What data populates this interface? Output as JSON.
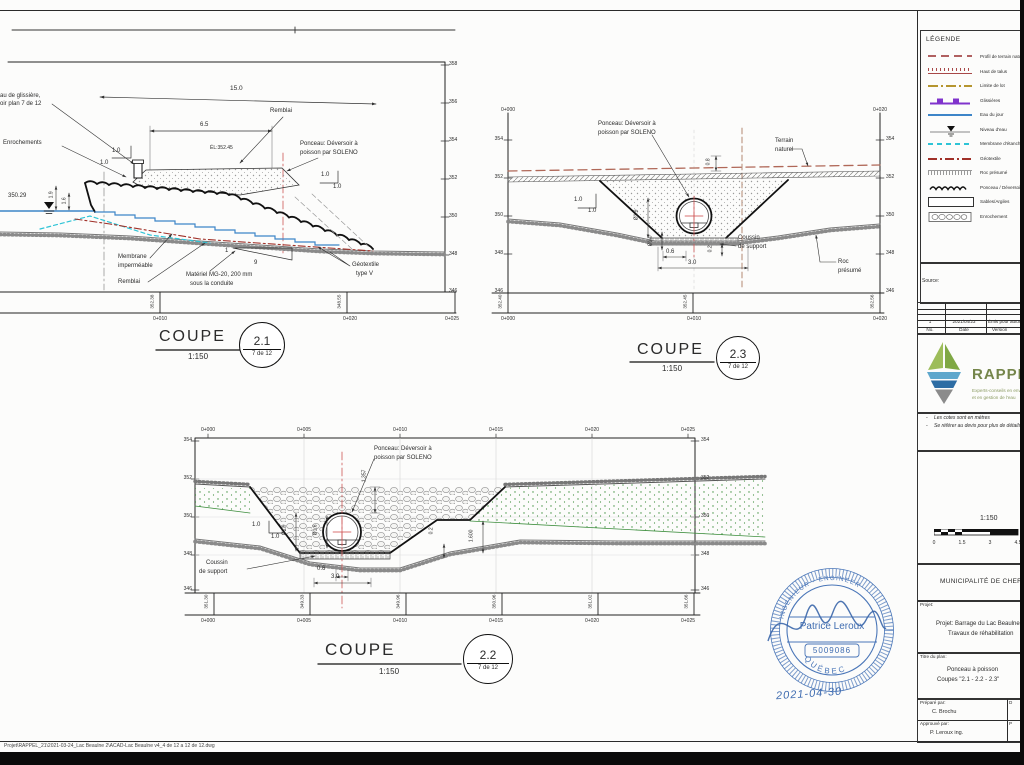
{
  "common": {
    "coupe": "COUPE",
    "scale": "1:150",
    "sheet_ref": "7 de 12",
    "ponceau_line1": "Ponceau: Déversoir à",
    "ponceau_line2": "poisson par SOLENO",
    "slope": "1.0"
  },
  "c21": {
    "bubble": "2.1",
    "elev": [
      "358",
      "356",
      "354",
      "352",
      "350",
      "348",
      "346"
    ],
    "stations": [
      "0+010",
      "0+020",
      "0+025"
    ],
    "datums": [
      "352.38",
      "348.55"
    ],
    "labels": {
      "glissiere1": "au de glissière,",
      "glissiere2": "oir plan 7 de 12",
      "enrochements": "Enrochements",
      "water_level": "350.29",
      "dim_h1": "1.9",
      "dim_h2": "1.6",
      "dim_crest": "6.5",
      "el_crest": "ÉL:352.45",
      "dim_base": "15.0",
      "remblai": "Remblai",
      "membrane1": "Membrane",
      "membrane2": "imperméable",
      "remblai2": "Remblai",
      "mg20_1": "Matériel MG-20, 200 mm",
      "mg20_2": "sous la conduite",
      "slope_v": "1",
      "slope_h": "9",
      "geotextile1": "Géotextile",
      "geotextile2": "type V"
    }
  },
  "c23": {
    "bubble": "2.3",
    "elev_left": [
      "354",
      "352",
      "350",
      "348",
      "346"
    ],
    "elev_right": [
      "354",
      "352",
      "350",
      "348",
      "346"
    ],
    "stations_top": [
      "0+000",
      "0+020"
    ],
    "stations": [
      "0+000",
      "0+010",
      "0+020"
    ],
    "datums": [
      "352.40",
      "352.45",
      "352.56"
    ],
    "labels": {
      "terrain1": "Terrain",
      "terrain2": "naturel",
      "dim_cover": "0.8",
      "dia_pipe": "Ø1.9",
      "dia_bed": "Ø1.0",
      "coussin1": "Coussin",
      "coussin2": "de support",
      "roc1": "Roc",
      "roc2": "présumé",
      "dim_key": "0.6",
      "dim_bed": "0.2",
      "dim_width": "3.0"
    }
  },
  "c22": {
    "bubble": "2.2",
    "elev_left": [
      "354",
      "352",
      "350",
      "348",
      "346"
    ],
    "elev_right": [
      "354",
      "352",
      "350",
      "348",
      "346"
    ],
    "stations": [
      "0+000",
      "0+005",
      "0+010",
      "0+015",
      "0+020",
      "0+025"
    ],
    "datums": [
      "351.30",
      "349.33",
      "349.96",
      "350.96",
      "351.02",
      "351.66"
    ],
    "labels": {
      "dim_depth": "1.357",
      "dia_out": "Ø1.9",
      "dia_in": "Ø1.6",
      "dim_bed": "0.2",
      "dim_bench": "1.600",
      "coussin1": "Coussin",
      "coussin2": "de support",
      "dim_key": "0.6",
      "dim_width": "3.0"
    }
  },
  "legend": {
    "title": "LÉGENDE",
    "items": [
      {
        "label": "Profil de terrain naturel"
      },
      {
        "label": "Haut de talus"
      },
      {
        "label": "Limite de lot"
      },
      {
        "label": "Glissières"
      },
      {
        "label": "Eau du jour"
      },
      {
        "label": "Niveau d'eau"
      },
      {
        "label": "Membrane d'étanchéité"
      },
      {
        "label": "Géotextile"
      },
      {
        "label": "Roc présumé"
      },
      {
        "label": "Ponceau / Déversoir"
      },
      {
        "label": "Sables/Argiles"
      },
      {
        "label": "Enrochement"
      }
    ]
  },
  "panel": {
    "source_label": "Source:",
    "rev": {
      "no": "1",
      "date": "2021/04/23",
      "desc": "Émis pour autorisation",
      "col_no": "No.",
      "col_date": "Date",
      "col_version": "Version"
    },
    "logo": {
      "name": "RAPPEL",
      "tag1": "Experts-conseils en environnement",
      "tag2": "et en gestion de l'eau"
    },
    "notes": {
      "bullet": "-",
      "n1": "Les cotes sont en mètres",
      "n2": "Se référer au devis pour plus de détails"
    },
    "scalebar": {
      "ratio": "1:150",
      "ticks": [
        "0",
        "1.5",
        "3",
        "4.5"
      ]
    },
    "municipality": "MUNICIPALITÉ DE CHERTSEY",
    "project": {
      "label": "Projet:",
      "line1": "Projet:  Barrage du Lac Beaulne",
      "line2": "Travaux de réhabilitation"
    },
    "plan": {
      "label": "Titre du plan:",
      "line1": "Ponceau à poisson",
      "line2": "Coupes \"2.1 - 2.2 - 2.3\""
    },
    "sig": {
      "prep_label": "Préparé par:",
      "prep": "C. Brochu",
      "appr_label": "Approuvé par:",
      "appr": "P. Leroux ing.",
      "col_d": "D",
      "col_p": "P"
    }
  },
  "stamp": {
    "arc_top": "INGÉNIEUR - ENGINEER",
    "name": "Patrice Leroux",
    "number": "5009086",
    "region": "QUÉBEC",
    "date": "2021-04-30"
  },
  "sheet": {
    "file_path": "Projet\\RAPPEL_21\\2021-03-24_Lac Beaulne 2\\ACAD-Lac Beaulne v4_4 de 12 a 12 de 12.dwg"
  }
}
